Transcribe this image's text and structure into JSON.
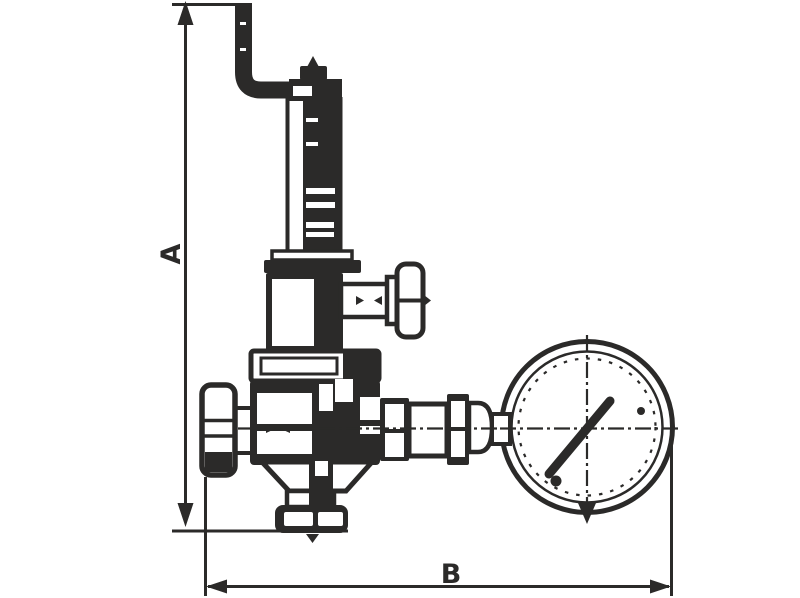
{
  "figure": {
    "type": "technical-dimension-drawing",
    "description": "Line drawing of a pressure reducing valve with top lever pipe, side T-handle valves, bottom outlet flange and pressure gauge",
    "background_color": "#ffffff",
    "line_color": "#2b2a29"
  },
  "dimensions": {
    "vertical": {
      "label": "A"
    },
    "horizontal": {
      "label": "B"
    }
  }
}
